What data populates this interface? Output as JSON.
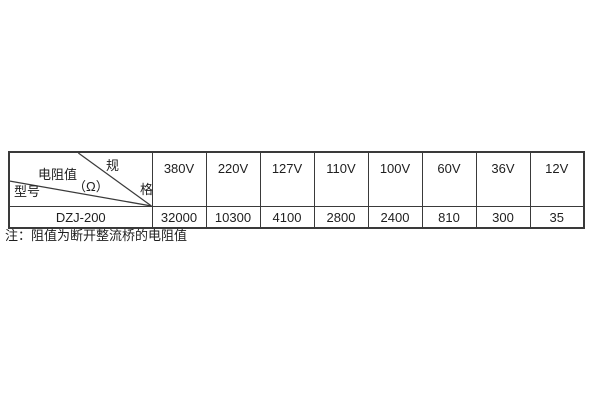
{
  "table": {
    "corner": {
      "spec_label": "规格",
      "spec_char_top": "规",
      "spec_char_bottom": "格",
      "middle_label": "电阻值",
      "middle_unit": "（Ω）",
      "bottom_label": "型号"
    },
    "columns": [
      "380V",
      "220V",
      "127V",
      "110V",
      "100V",
      "60V",
      "36V",
      "12V"
    ],
    "rows": [
      {
        "model": "DZJ-200",
        "values": [
          "32000",
          "10300",
          "4100",
          "2800",
          "2400",
          "810",
          "300",
          "35"
        ]
      }
    ]
  },
  "note": "注：阻值为断开整流桥的电阻值",
  "colors": {
    "border": "#3a3a3a",
    "text": "#1e1e1e",
    "background": "#ffffff"
  }
}
